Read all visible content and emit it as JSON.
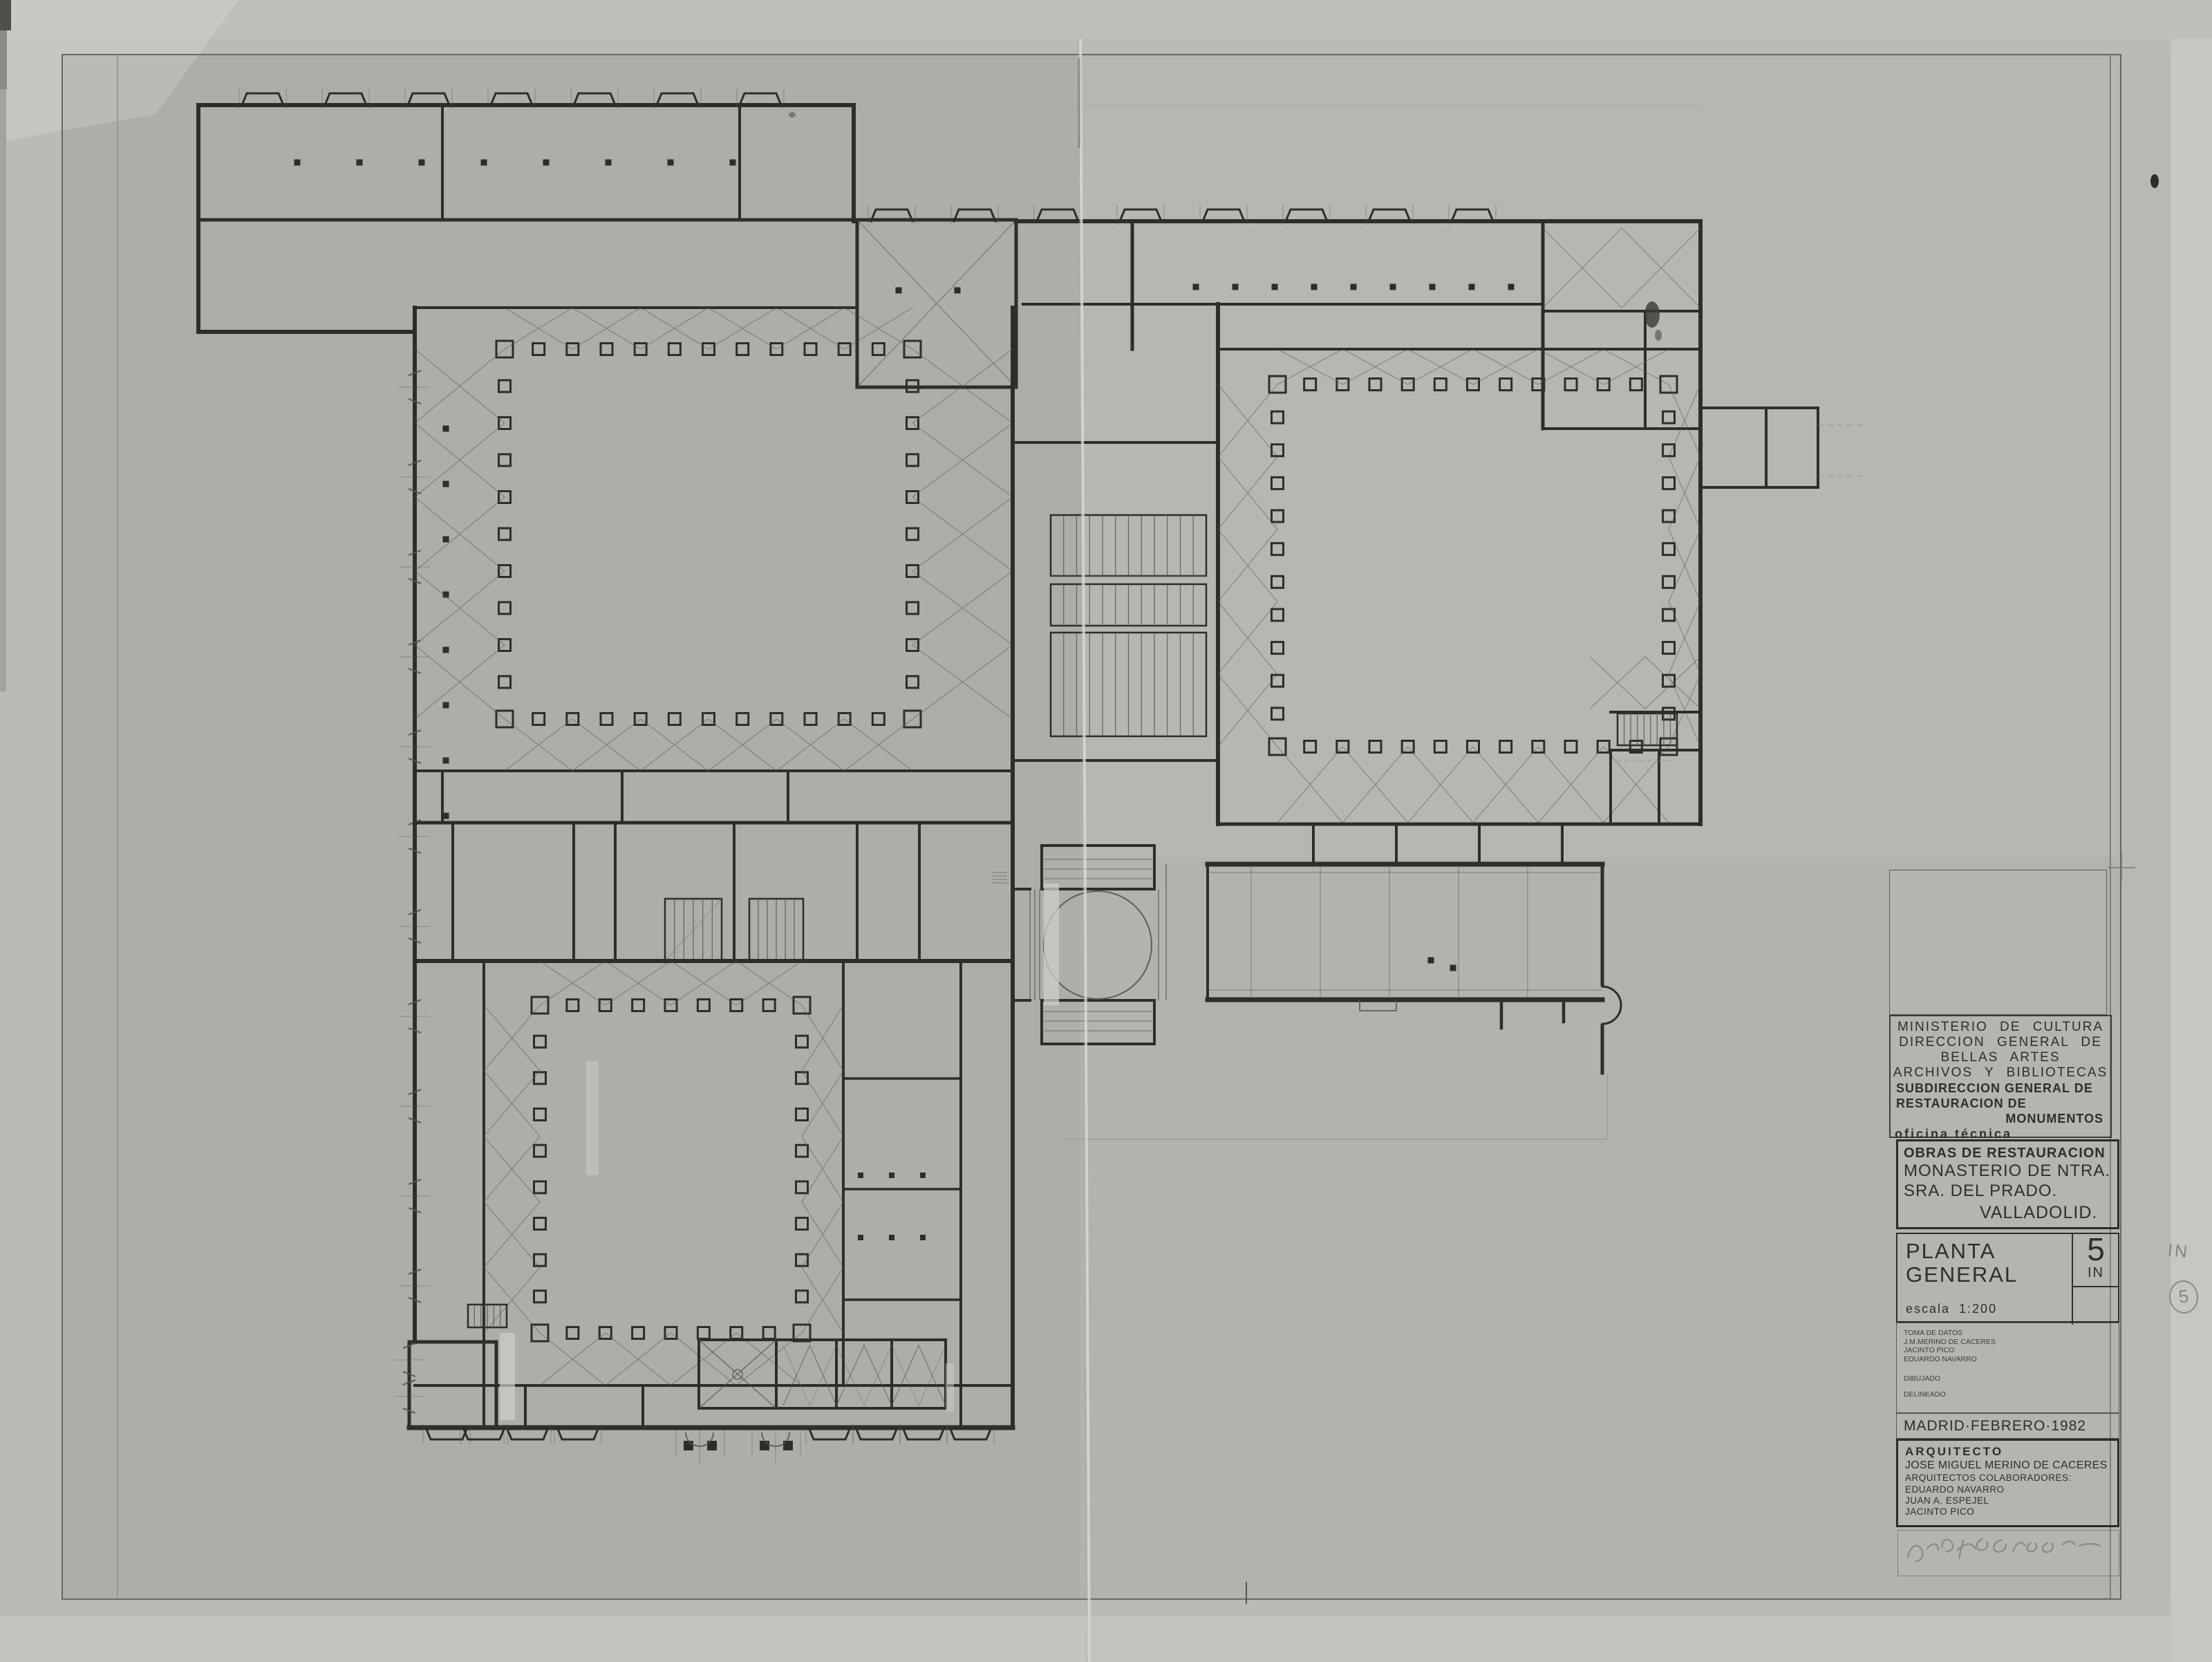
{
  "sheet": {
    "agency_lines": [
      "MINISTERIO  DE  CULTURA",
      "DIRECCION GENERAL DE",
      "BELLAS ARTES",
      "ARCHIVOS Y BIBLIOTECAS"
    ],
    "subdirection_lines": [
      "SUBDIRECCION GENERAL DE",
      "RESTAURACION DE",
      "MONUMENTOS"
    ],
    "office": "oficina técnica",
    "project": {
      "heading": "OBRAS DE RESTAURACION",
      "name_line1": "MONASTERIO DE NTRA.",
      "name_line2": "SRA. DEL PRADO.",
      "city": "VALLADOLID."
    },
    "drawing": {
      "title_line1": "PLANTA",
      "title_line2": "GENERAL",
      "scale_label": "escala 1:200",
      "sheet_number": "5",
      "sheet_suffix": "IN"
    },
    "credits": {
      "toma_label": "TOMA DE DATOS",
      "toma_names": [
        "J.M.MERINO DE CACERES",
        "JACINTO PICO",
        "EDUARDO NAVARRO"
      ],
      "dibujado_label": "DIBUJADO",
      "delineado_label": "DELINEADO"
    },
    "date_place": "MADRID·FEBRERO·1982",
    "architect": {
      "label": "ARQUITECTO",
      "name": "JOSE MIGUEL MERINO DE CACERES",
      "collaborators_label": "ARQUITECTOS COLABORADORES:",
      "collaborators": [
        "EDUARDO NAVARRO",
        "JUAN A. ESPEJEL",
        "JACINTO PICO"
      ]
    },
    "annotations": {
      "margin_note": "IN",
      "margin_circled_number": "5"
    }
  },
  "plan": {
    "type": "architectural-floor-plan",
    "subject": "Planta general del Monasterio de Ntra. Sra. del Prado, Valladolid",
    "scale": "1:200",
    "features": [
      "northwest cloister with column ring",
      "northeast cloister with column ring",
      "southwest cloister with column ring",
      "church crossing with dome circle and nave",
      "stair halls",
      "entrance porches on south facade",
      "buttressed north and west facades"
    ]
  },
  "colors": {
    "paper": "#b3b2ae",
    "paper_margin": "#bbbab6",
    "paper_light": "#c7c6c2",
    "ink": "#2e2d28",
    "ink_light": "#55544f",
    "pencil": "#8a8984"
  }
}
